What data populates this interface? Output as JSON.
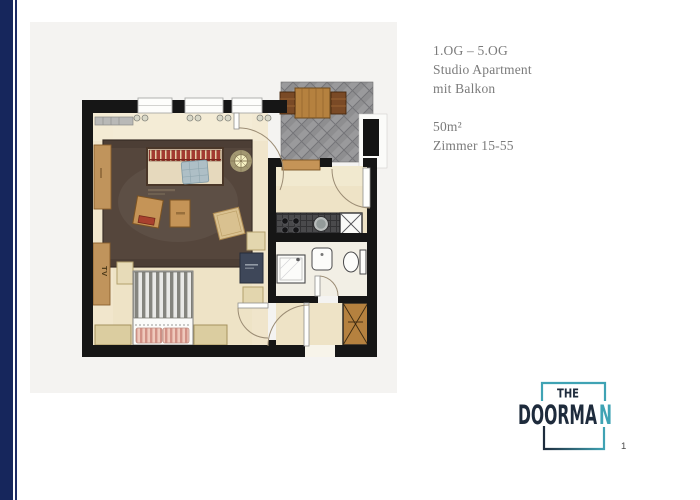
{
  "page": {
    "background": "#ffffff",
    "accent_bar_color": "#16265c",
    "page_number": "1"
  },
  "info": {
    "text_color": "#7b7b7b",
    "lines": [
      "1.OG – 5.OG",
      "Studio Apartment",
      "mit Balkon",
      "50m²",
      "Zimmer 15-55"
    ]
  },
  "logo": {
    "top_word": "THE",
    "main_dark": "DOORMA",
    "main_accent": "N",
    "navy": "#1e2b3c",
    "teal": "#3fa3b4"
  },
  "floorplan": {
    "canvas_bg": "#f4f3f1",
    "wall_color": "#161616",
    "floor_color": "#eee3c6",
    "rug_color": "#55463c",
    "wood_color": "#c59457",
    "balcony_brick_color": "#97979b",
    "labels": {
      "tv": "TV"
    }
  }
}
